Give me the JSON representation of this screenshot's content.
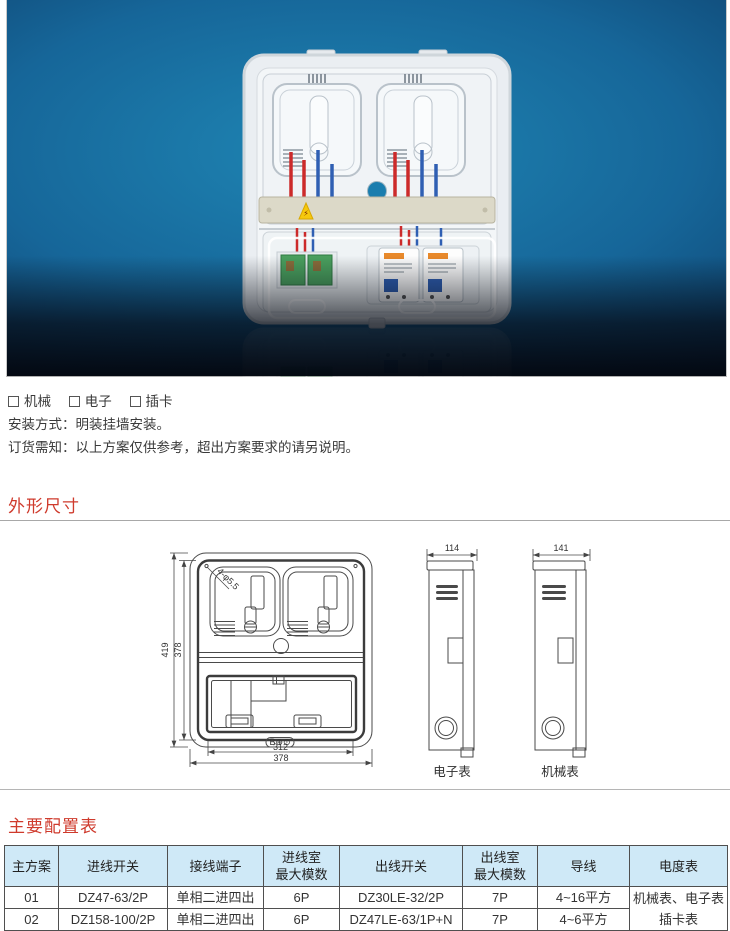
{
  "photo": {
    "bg_center_color": "#1f86b4",
    "bg_edge_color": "#081830",
    "warning_icon": "⚡",
    "badge_glyphs": "B⊕⊙"
  },
  "checkbox_options": {
    "items": [
      "机械",
      "电子",
      "插卡"
    ]
  },
  "install_line": "安装方式：明装挂墙安装。",
  "order_line": "订货需知：以上方案仅供参考，超出方案要求的请另说明。",
  "sections": {
    "dimensions_title": "外形尺寸",
    "config_title": "主要配置表"
  },
  "drawing": {
    "front": {
      "height": "419",
      "inner_height": "378",
      "inner_width": "312",
      "width": "378",
      "holes": "4-φ5.5",
      "badge": "B⊕⊙"
    },
    "side_electronic": {
      "width": "114",
      "label": "电子表"
    },
    "side_mechanical": {
      "width": "141",
      "label": "机械表"
    }
  },
  "table": {
    "header_bg": "#cfe9f7",
    "headers": [
      "主方案",
      "进线开关",
      "接线端子",
      "进线室\n最大模数",
      "出线开关",
      "出线室\n最大模数",
      "导线",
      "电度表"
    ],
    "rows": [
      [
        "01",
        "DZ47-63/2P",
        "单相二进四出",
        "6P",
        "DZ30LE-32/2P",
        "7P",
        "4~16平方",
        "机械表、电子表"
      ],
      [
        "02",
        "DZ158-100/2P",
        "单相二进四出",
        "6P",
        "DZ47LE-63/1P+N",
        "7P",
        "4~6平方",
        "插卡表"
      ]
    ]
  },
  "accent_red": "#cf3a2c"
}
